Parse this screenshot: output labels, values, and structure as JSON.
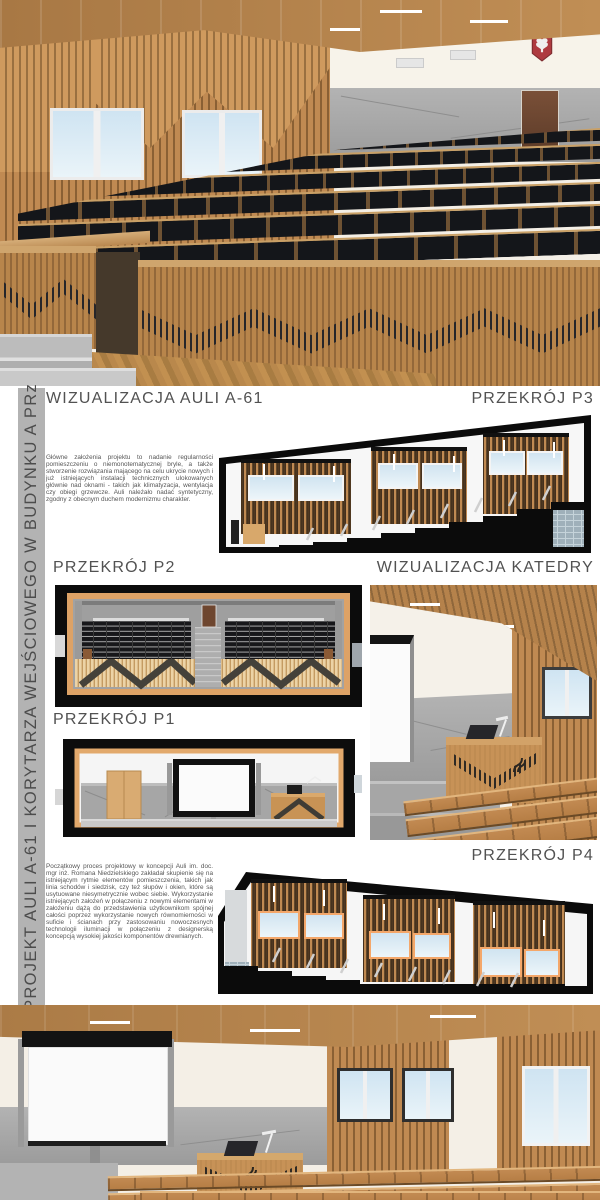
{
  "poster": {
    "sidebar": {
      "title": "PROJEKT AULI A-61 I KORYTARZA WEJŚCIOWEGO W BUDYNKU A PRz"
    },
    "sections": {
      "aula": {
        "heading": "WIZUALIZACJA AULI A-61"
      },
      "p3": {
        "heading": "PRZEKRÓJ P3"
      },
      "p2": {
        "heading": "PRZEKRÓJ P2"
      },
      "katedra": {
        "heading": "WIZUALIZACJA KATEDRY"
      },
      "p1": {
        "heading": "PRZEKRÓJ P1"
      },
      "p4": {
        "heading": "PRZEKRÓJ P4"
      }
    },
    "notes": {
      "design_goals": "Główne założenia projektu to nadanie regularności pomieszczeniu o niemonotematycznej bryle, a także stworzenie rozwiązania mającego na celu ukrycie nowych i już istniejących instalacji technicznych ulokowanych głównie nad oknami - takich jak klimatyzacja, wentylacja czy obiegi grzewcze. Auli należało nadać syntetyczny, zgodny z obecnym duchem modernizmu charakter.",
      "design_process": "Początkowy proces projektowy w koncepcji Auli im. doc. mgr inż. Romana Niedzielskiego zakładał skupienie się na istniejącym rytmie elementów pomieszczenia, takich jak linia schodów i siedzisk, czy też słupów i okien, które są usytuowane niesymetrycznie wobec siebie. Wykorzystanie istniejących założeń w połączeniu z nowymi elementami w założeniu dążą do przedstawienia użytkownikom spójnej całości poprzez wykorzystanie nowych równomierności w suficie i ścianach przy zastosowaniu nowoczesnych technologii iluminacji w połączeniu z designerską koncepcją wysokiej jakości komponentów drewnianych."
    },
    "colors": {
      "wood": "#c08a52",
      "wood_dark": "#8a6238",
      "ceiling_wood": "#b5824b",
      "seat_black": "#17181c",
      "concrete": "#a5a5a5",
      "sidebar_bg": "#b3b3b3",
      "heading_text": "#525252",
      "emblem_red": "#ae3a40",
      "sky_window": "#cfe4f2",
      "drawing_black": "#0c0c0c"
    }
  }
}
